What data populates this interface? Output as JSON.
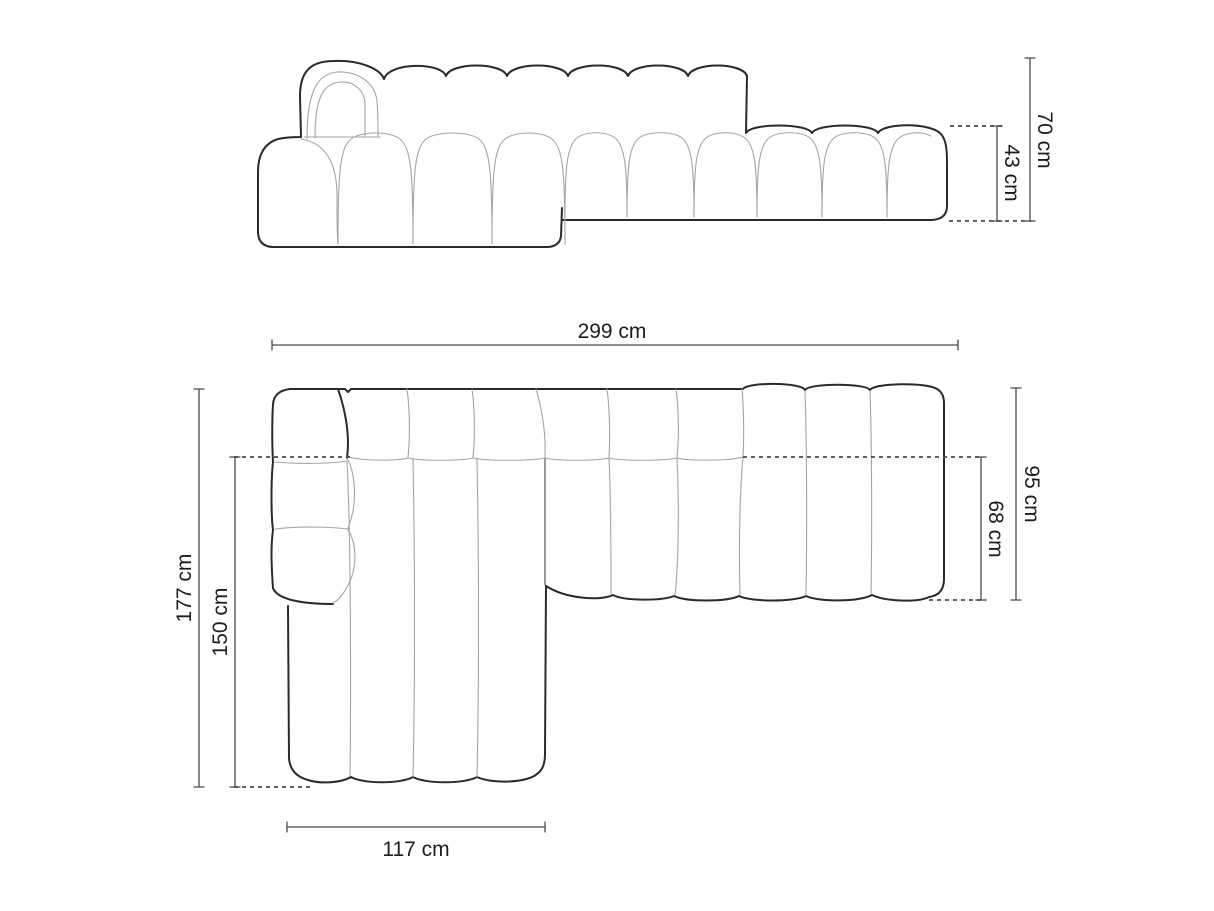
{
  "diagram": {
    "type": "furniture-dimension-drawing",
    "background": "#ffffff",
    "colors": {
      "outline": "#2a2a2a",
      "seam": "#a5a5a5",
      "dash": "#4a4a4a",
      "dimension": "#4a4a4a",
      "label": "#1d1d1d"
    },
    "front_view": {
      "labels": {
        "total_height": "70 cm",
        "seat_height": "43 cm"
      }
    },
    "top_view": {
      "labels": {
        "total_width": "299 cm",
        "total_depth": "177 cm",
        "chaise_length": "150 cm",
        "right_depth": "95 cm",
        "seat_depth": "68 cm",
        "chaise_width": "117 cm"
      }
    }
  }
}
